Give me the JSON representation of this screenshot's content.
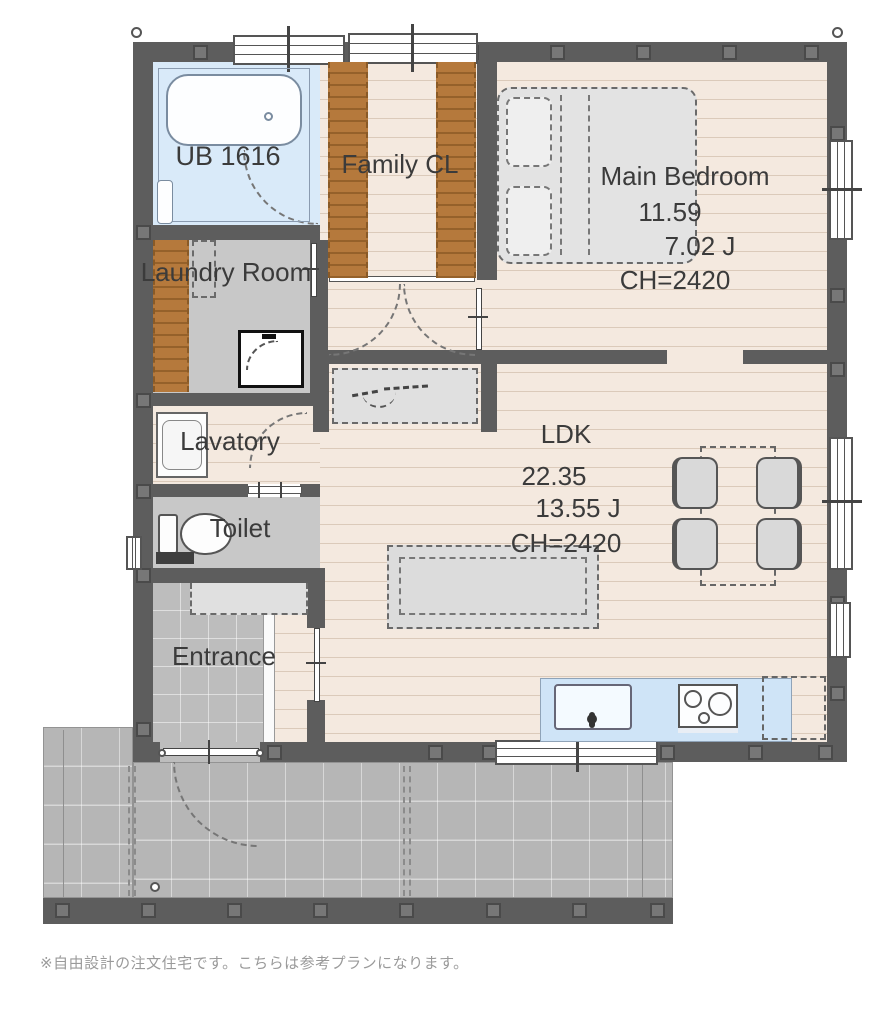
{
  "labels": {
    "bath": "UB 1616",
    "family_cl": "Family CL",
    "bedroom": "Main Bedroom",
    "bedroom_area": "11.59",
    "bedroom_jo": "7.02 J",
    "bedroom_ch": "CH=2420",
    "laundry": "Laundry Room",
    "lavatory": "Lavatory",
    "toilet": "Toilet",
    "entrance": "Entrance",
    "ldk": "LDK",
    "ldk_area": "22.35",
    "ldk_jo": "13.55 J",
    "ldk_ch": "CH=2420"
  },
  "note": "※自由設計の注文住宅です。こちらは参考プランになります。",
  "colors": {
    "wall": "#5d5d5d",
    "wood_floor": "#f4e9df",
    "bath_blue": "#d9eaf9",
    "kitchen_blue": "#cfe4f7",
    "service_gray": "#c8c8c8",
    "entrance_tile": "#bdbdbd",
    "deck_gray": "#b6b6b6",
    "closet_brown": "#b5793c",
    "label_text": "#3b3b3b",
    "note_text": "#9a9a9a"
  }
}
